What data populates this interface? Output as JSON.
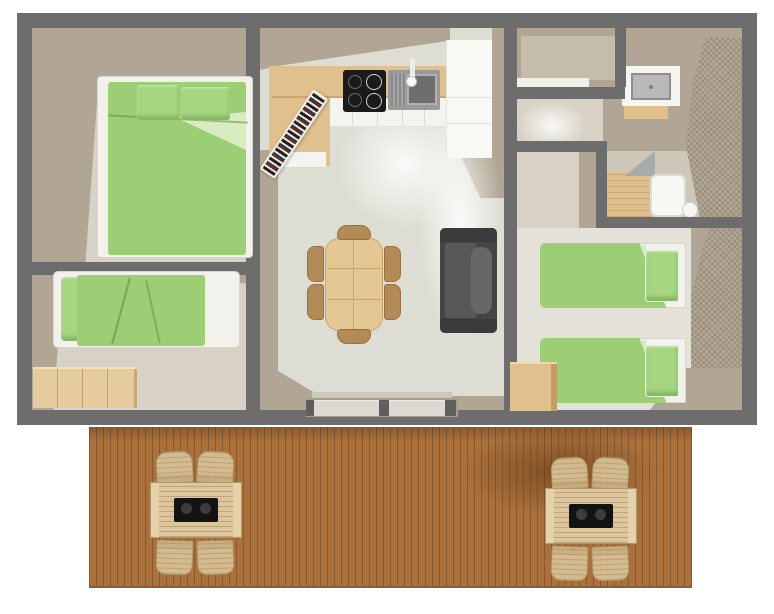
{
  "meta": {
    "type": "3D rendered floor plan of a holiday mobile home / chalet, top view, no text labels",
    "canvas": {
      "width": 774,
      "height": 614
    }
  },
  "rooms": [
    {
      "id": "bedroom-double",
      "label": "Double bedroom with double bed"
    },
    {
      "id": "bedroom-single",
      "label": "Single bedroom with single bed and storage shelf"
    },
    {
      "id": "living-kitchen",
      "label": "Living room with kitchenette, dining table and sofa"
    },
    {
      "id": "wc",
      "label": "Separate WC room"
    },
    {
      "id": "hallway",
      "label": "Hallway"
    },
    {
      "id": "shower-room",
      "label": "Shower room with washbasin and shower tray"
    },
    {
      "id": "bedroom-twin",
      "label": "Twin bedroom with two single beds"
    },
    {
      "id": "terrace",
      "label": "Wooden terrace with two picnic table sets"
    }
  ],
  "furniture": [
    {
      "room": "bedroom-double",
      "item": "double bed, green bedding, two pillows"
    },
    {
      "room": "bedroom-single",
      "item": "single bed, green bedding"
    },
    {
      "room": "bedroom-single",
      "item": "wooden shelf unit"
    },
    {
      "room": "living-kitchen",
      "item": "kitchen counter with cooktop (4 burners) and sink"
    },
    {
      "room": "living-kitchen",
      "item": "fridge / tall white cabinet"
    },
    {
      "room": "living-kitchen",
      "item": "leaning ladder shelf"
    },
    {
      "room": "living-kitchen",
      "item": "dining table with six wooden chairs"
    },
    {
      "room": "living-kitchen",
      "item": "dark gray sofa"
    },
    {
      "room": "living-kitchen",
      "item": "double sliding entrance door"
    },
    {
      "room": "shower-room",
      "item": "washbasin on white counter"
    },
    {
      "room": "shower-room",
      "item": "shower tray with wooden mat"
    },
    {
      "room": "bedroom-twin",
      "item": "single bed A, green bedding"
    },
    {
      "room": "bedroom-twin",
      "item": "single bed B, green bedding"
    },
    {
      "room": "bedroom-twin",
      "item": "wooden bedside cube"
    },
    {
      "room": "terrace",
      "item": "picnic table with black tray and four chairs (x2)"
    }
  ],
  "colors": {
    "wall": "#6d6d6d",
    "taupe": "#b1a695",
    "floorBeige": "#d7d2c5",
    "floorLight": "#deddd4",
    "green": "#9ccf75",
    "greenLight": "#a6d680",
    "sheet": "#d9ecc1",
    "wood": "#e0c18e",
    "chairWood": "#b28a55",
    "deck": "#aa713c",
    "sofa": "#454545",
    "white": "#f2f1ec"
  }
}
